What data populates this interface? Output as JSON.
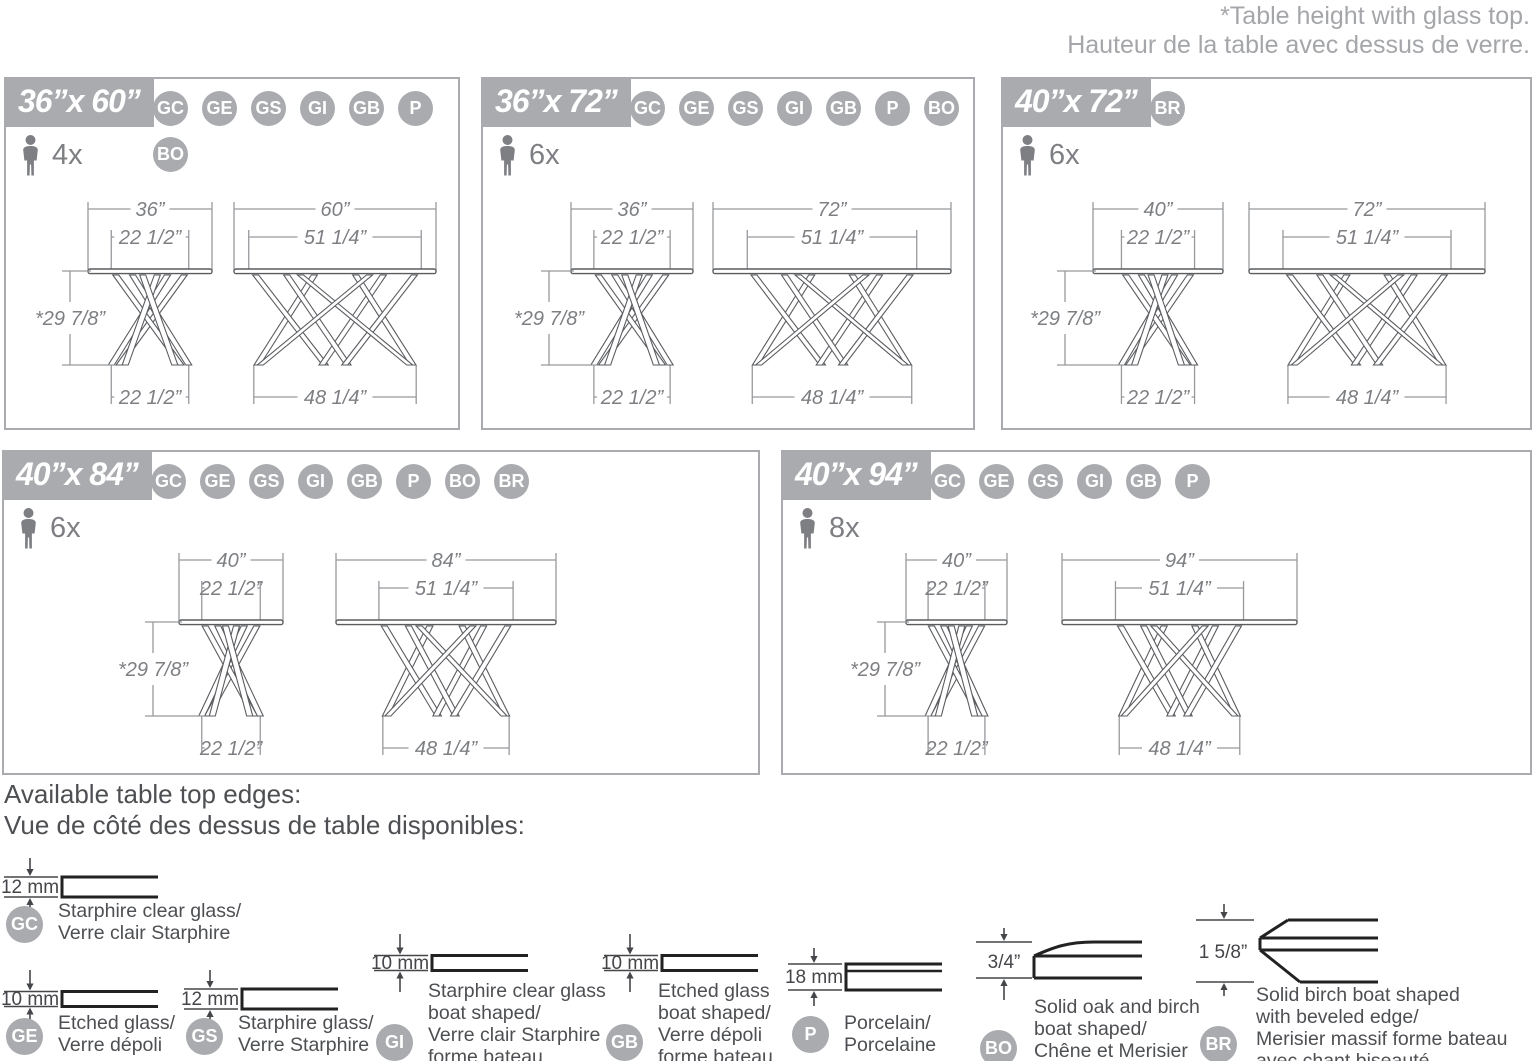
{
  "note": {
    "line1": "*Table height with glass top.",
    "line2": "Hauteur de la table avec dessus de verre."
  },
  "colors": {
    "accent_gray": "#a9abae",
    "drawing_gray": "#5a5c5f",
    "dim_line_gray": "#97999c",
    "dim_text_gray": "#7d7f83",
    "note_gray": "#a4a6a9",
    "text_dark": "#4d4f52",
    "profile_black": "#222222"
  },
  "panels": [
    {
      "size": "36”x 60”",
      "seats": "4x",
      "badges_row1": [
        "GC",
        "GE",
        "GS",
        "GI",
        "GB",
        "P"
      ],
      "badges_row2": [
        "BO"
      ],
      "height_label": "*29 7/8”",
      "end_view": {
        "top": "36”",
        "inner": "22 1/2”",
        "bottom": "22 1/2”"
      },
      "side_view": {
        "top": "60”",
        "inner": "51 1/4”",
        "bottom": "48 1/4”"
      }
    },
    {
      "size": "36”x 72”",
      "seats": "6x",
      "badges_row1": [
        "GC",
        "GE",
        "GS",
        "GI",
        "GB",
        "P",
        "BO"
      ],
      "badges_row2": [],
      "height_label": "*29 7/8”",
      "end_view": {
        "top": "36”",
        "inner": "22 1/2”",
        "bottom": "22 1/2”"
      },
      "side_view": {
        "top": "72”",
        "inner": "51 1/4”",
        "bottom": "48 1/4”"
      }
    },
    {
      "size": "40”x 72”",
      "seats": "6x",
      "badges_row1": [
        "BR"
      ],
      "badges_row2": [],
      "height_label": "*29 7/8”",
      "end_view": {
        "top": "40”",
        "inner": "22 1/2”",
        "bottom": "22 1/2”"
      },
      "side_view": {
        "top": "72”",
        "inner": "51 1/4”",
        "bottom": "48 1/4”"
      }
    },
    {
      "size": "40”x 84”",
      "seats": "6x",
      "badges_row1": [
        "GC",
        "GE",
        "GS",
        "GI",
        "GB",
        "P",
        "BO",
        "BR"
      ],
      "badges_row2": [],
      "height_label": "*29 7/8”",
      "end_view": {
        "top": "40”",
        "inner": "22 1/2”",
        "bottom": "22 1/2”"
      },
      "side_view": {
        "top": "84”",
        "inner": "51 1/4”",
        "bottom": "48 1/4”"
      }
    },
    {
      "size": "40”x 94”",
      "seats": "8x",
      "badges_row1": [
        "GC",
        "GE",
        "GS",
        "GI",
        "GB",
        "P"
      ],
      "badges_row2": [],
      "height_label": "*29 7/8”",
      "end_view": {
        "top": "40”",
        "inner": "22 1/2”",
        "bottom": "22 1/2”"
      },
      "side_view": {
        "top": "94”",
        "inner": "51 1/4”",
        "bottom": "48 1/4”"
      }
    }
  ],
  "legend": {
    "heading_en": "Available table top edges:",
    "heading_fr": "Vue de côté des dessus de table disponibles:",
    "items": [
      {
        "code": "GC",
        "dim": "12 mm",
        "lines": [
          "Starphire clear glass/",
          "Verre clair Starphire"
        ]
      },
      {
        "code": "GE",
        "dim": "10 mm",
        "lines": [
          "Etched glass/",
          "Verre dépoli"
        ]
      },
      {
        "code": "GS",
        "dim": "12 mm",
        "lines": [
          "Starphire glass/",
          "Verre Starphire"
        ]
      },
      {
        "code": "GI",
        "dim": "10 mm",
        "lines": [
          "Starphire clear glass",
          "boat shaped/",
          "Verre clair Starphire",
          "forme bateau"
        ]
      },
      {
        "code": "GB",
        "dim": "10 mm",
        "lines": [
          "Etched glass",
          "boat shaped/",
          "Verre dépoli",
          "forme bateau"
        ]
      },
      {
        "code": "P",
        "dim": "18 mm",
        "lines": [
          "Porcelain/",
          "Porcelaine"
        ]
      },
      {
        "code": "BO",
        "dim": "3/4”",
        "lines": [
          "Solid oak and birch",
          "boat shaped/",
          "Chêne et Merisier",
          "massif forme bateau"
        ]
      },
      {
        "code": "BR",
        "dim": "1 5/8”",
        "lines": [
          "Solid birch boat shaped",
          "with beveled edge/",
          "Merisier massif forme bateau",
          "avec chant biseauté"
        ]
      }
    ]
  }
}
